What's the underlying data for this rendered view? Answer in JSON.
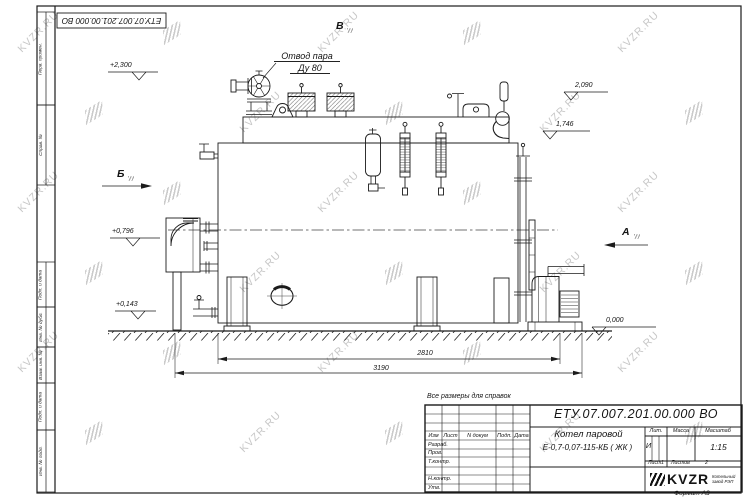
{
  "doc": {
    "number": "ЕТУ.07.007.201.00.000  ВО"
  },
  "page": {
    "note": "Все размеры для справок",
    "format": "Формат А3"
  },
  "title_block": {
    "doc_number": "ЕТУ.07.007.201.00.000  ВО",
    "product_line1": "Котел паровой",
    "product_line2": "Е-0,7-0,07-115-КБ ( ЖК )",
    "col_izm": "Изм",
    "col_list": "Лист",
    "col_ndokum": "N докум",
    "col_podp": "Подп.",
    "col_data": "Дата",
    "row_razrab": "Разраб.",
    "row_prov": "Пров.",
    "row_tkontr": "Т.контр.",
    "row_nkontr": "Н.контр.",
    "row_utv": "Утв.",
    "lit_label": "Лит.",
    "mass_label": "Масса",
    "scale_label": "Масштаб",
    "lit_value": "И",
    "scale_value": "1:15",
    "sheet_label": "Лист",
    "sheet_value": "1",
    "sheets_label": "Листов",
    "sheets_value": "2",
    "brand": "KVZR",
    "brand_sub": "Котельный завод РЭП"
  },
  "margin_labels": [
    "Перв. примен.",
    "Справ. №",
    "Подп. и дата",
    "Инв. № дубл.",
    "Взам. инв. №",
    "Подп. и дата",
    "Инв. № подл."
  ],
  "annotations": {
    "steam_outlet": "Отвод пара",
    "steam_dn": "Ду 80",
    "view_a": "А",
    "view_b": "Б",
    "view_v": "В",
    "lvl_2300": "+2,300",
    "lvl_2090": "2,090",
    "lvl_1746": "1,746",
    "lvl_0796": "+0,796",
    "lvl_0143": "+0,143",
    "lvl_0000": "0,000",
    "dim_2810": "2810",
    "dim_3190": "3190"
  },
  "watermark": {
    "text": "KVZR.RU"
  }
}
